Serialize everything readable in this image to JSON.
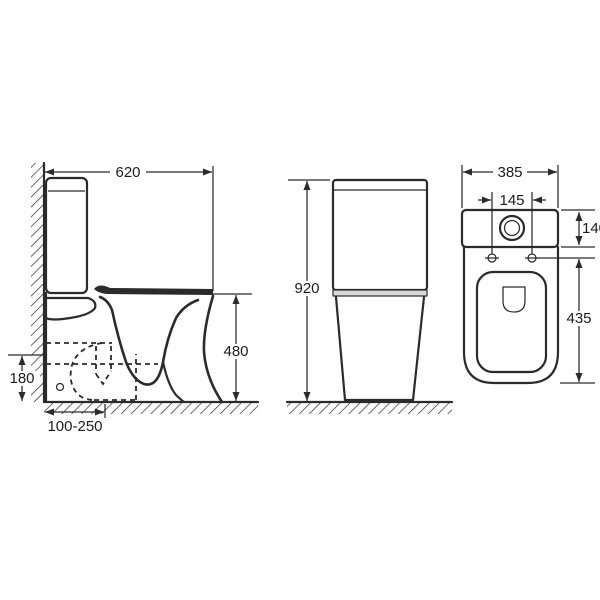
{
  "colors": {
    "line": "#2b2b2b",
    "background": "#ffffff"
  },
  "views": {
    "side": {
      "dims": {
        "width": "620",
        "seat_height": "480",
        "outlet_height": "180",
        "outlet_setout_range": "100-250"
      }
    },
    "front": {
      "dims": {
        "overall_height": "920"
      }
    },
    "top": {
      "dims": {
        "overall_width": "385",
        "fixing_hole_spacing": "145",
        "cistern_depth": "140",
        "pan_length": "435"
      }
    }
  }
}
